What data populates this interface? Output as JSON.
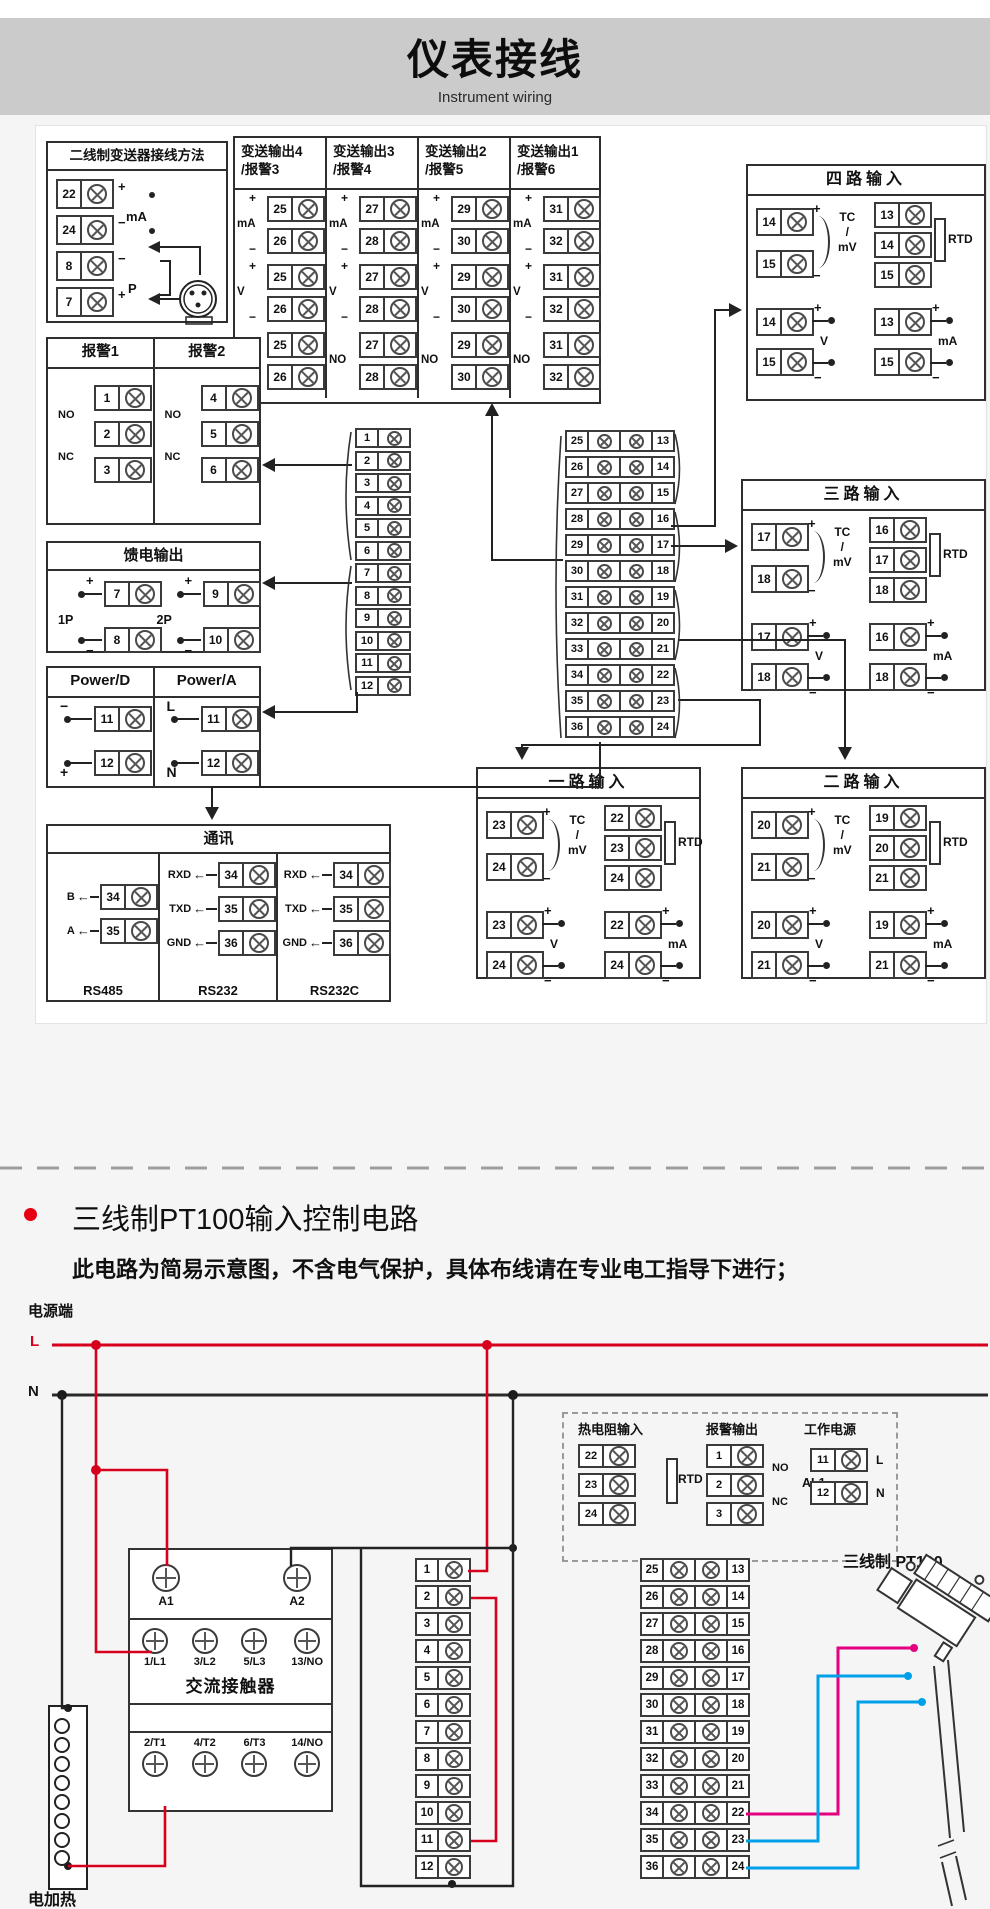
{
  "header": {
    "title": "仪表接线",
    "subtitle": "Instrument wiring"
  },
  "colors": {
    "accent_red": "#e60012",
    "wire_red": "#d6001c",
    "wire_magenta": "#e4007f",
    "wire_cyan": "#00a0e9",
    "wire_dark": "#222222",
    "header_band": "#cbcbcb"
  },
  "top": {
    "two_wire": {
      "title": "二线制变送器接线方法",
      "rows": [
        {
          "num": "22",
          "lab": "+"
        },
        {
          "num": "24",
          "lab": "−"
        },
        {
          "num": "8",
          "lab": "−"
        },
        {
          "num": "7",
          "lab": "+"
        }
      ],
      "ma": "mA",
      "p": "P"
    },
    "transmit": {
      "syms": {
        "plus": "+",
        "minus": "−",
        "ma": "mA",
        "v": "V",
        "no": "NO"
      },
      "cols": [
        {
          "t": "变送输出4",
          "s": "/报警3",
          "a": "25",
          "b": "26"
        },
        {
          "t": "变送输出3",
          "s": "/报警4",
          "a": "27",
          "b": "28"
        },
        {
          "t": "变送输出2",
          "s": "/报警5",
          "a": "29",
          "b": "30"
        },
        {
          "t": "变送输出1",
          "s": "/报警6",
          "a": "31",
          "b": "32"
        }
      ]
    },
    "inputs": [
      {
        "title": "四路输入",
        "tc1": "14",
        "tc2": "15",
        "r1": "13",
        "r2": "14",
        "r3": "15",
        "v1": "14",
        "v2": "15",
        "m1": "13",
        "m2": "15"
      },
      {
        "title": "三路输入",
        "tc1": "17",
        "tc2": "18",
        "r1": "16",
        "r2": "17",
        "r3": "18",
        "v1": "17",
        "v2": "18",
        "m1": "16",
        "m2": "18"
      },
      {
        "title": "一路输入",
        "tc1": "23",
        "tc2": "24",
        "r1": "22",
        "r2": "23",
        "r3": "24",
        "v1": "23",
        "v2": "24",
        "m1": "22",
        "m2": "24"
      },
      {
        "title": "二路输入",
        "tc1": "20",
        "tc2": "21",
        "r1": "19",
        "r2": "20",
        "r3": "21",
        "v1": "20",
        "v2": "21",
        "m1": "19",
        "m2": "21"
      }
    ],
    "input_labels": {
      "tc": "TC",
      "slash": "/",
      "mv": "mV",
      "rtd": "RTD",
      "v": "V",
      "ma": "mA",
      "plus": "+",
      "minus": "−"
    },
    "alarm": {
      "sections": [
        {
          "title": "报警1",
          "a": "1",
          "b": "2",
          "c": "3"
        },
        {
          "title": "报警2",
          "a": "4",
          "b": "5",
          "c": "6"
        }
      ],
      "no": "NO",
      "nc": "NC"
    },
    "feed": {
      "title": "馈电输出",
      "groups": [
        {
          "lab": "1P",
          "a": "7",
          "b": "8"
        },
        {
          "lab": "2P",
          "a": "9",
          "b": "10"
        }
      ]
    },
    "power": {
      "sections": [
        {
          "title": "Power/D",
          "l1": "−",
          "a": "11",
          "l2": "+",
          "b": "12"
        },
        {
          "title": "Power/A",
          "l1": "L",
          "a": "11",
          "l2": "N",
          "b": "12"
        }
      ]
    },
    "comm": {
      "title": "通讯",
      "arrow": "←",
      "sec1": {
        "cap": "RS485",
        "rows": [
          {
            "sig": "B",
            "t": "34"
          },
          {
            "sig": "A",
            "t": "35"
          }
        ]
      },
      "sec2": {
        "cap": "RS232",
        "rows": [
          {
            "sig": "RXD",
            "t": "34"
          },
          {
            "sig": "TXD",
            "t": "35"
          },
          {
            "sig": "GND",
            "t": "36"
          }
        ]
      },
      "sec3": {
        "cap": "RS232C",
        "rows": [
          {
            "sig": "RXD",
            "t": "34"
          },
          {
            "sig": "TXD",
            "t": "35"
          },
          {
            "sig": "GND",
            "t": "36"
          }
        ]
      }
    },
    "strip_a": [
      "1",
      "2",
      "3",
      "4",
      "5",
      "6",
      "7",
      "8",
      "9",
      "10",
      "11",
      "12"
    ],
    "strip_b": [
      {
        "l": "25",
        "r": "13"
      },
      {
        "l": "26",
        "r": "14"
      },
      {
        "l": "27",
        "r": "15"
      },
      {
        "l": "28",
        "r": "16"
      },
      {
        "l": "29",
        "r": "17"
      },
      {
        "l": "30",
        "r": "18"
      },
      {
        "l": "31",
        "r": "19"
      },
      {
        "l": "32",
        "r": "20"
      },
      {
        "l": "33",
        "r": "21"
      },
      {
        "l": "34",
        "r": "22"
      },
      {
        "l": "35",
        "r": "23"
      },
      {
        "l": "36",
        "r": "24"
      }
    ]
  },
  "notes": [
    "注1：接线图中在同一组端子标有不同功能的,只能选择其中一种功能。",
    "如RS485和RS232在同一组接线端子上，只能选择一种。",
    "注2：不同外形尺寸仪表，接线图不尽相同，请以实物为准。"
  ],
  "pt100": {
    "heading": "三线制PT100输入控制电路",
    "sub": "此电路为简易示意图，不含电气保护，具体布线请在专业电工指导下进行；",
    "power_label": "电源端",
    "l": "L",
    "n": "N",
    "dashed": {
      "rtd": {
        "title": "热电阻输入",
        "rows": [
          "22",
          "23",
          "24"
        ],
        "lab": "RTD"
      },
      "alarm": {
        "title": "报警输出",
        "rows": [
          "1",
          "2",
          "3"
        ],
        "no": "NO",
        "nc": "NC",
        "al1": "AL1"
      },
      "work": {
        "title": "工作电源",
        "rows": [
          {
            "t": "11",
            "lab": "L"
          },
          {
            "t": "12",
            "lab": "N"
          }
        ]
      }
    },
    "contactor": {
      "coils": [
        {
          "lab": "A1"
        },
        {
          "lab": "A2"
        }
      ],
      "top": [
        {
          "lab": "1/L1"
        },
        {
          "lab": "3/L2"
        },
        {
          "lab": "5/L3"
        },
        {
          "lab": "13/NO"
        }
      ],
      "name": "交流接触器",
      "bottom": [
        {
          "lab": "2/T1"
        },
        {
          "lab": "4/T2"
        },
        {
          "lab": "6/T3"
        },
        {
          "lab": "14/NO"
        }
      ]
    },
    "heater": "电加热",
    "sensor": "三线制 PT100",
    "wire_labels": [
      "A",
      "B",
      "B"
    ],
    "strip_a": [
      "1",
      "2",
      "3",
      "4",
      "5",
      "6",
      "7",
      "8",
      "9",
      "10",
      "11",
      "12"
    ],
    "strip_b": [
      {
        "l": "25",
        "r": "13"
      },
      {
        "l": "26",
        "r": "14"
      },
      {
        "l": "27",
        "r": "15"
      },
      {
        "l": "28",
        "r": "16"
      },
      {
        "l": "29",
        "r": "17"
      },
      {
        "l": "30",
        "r": "18"
      },
      {
        "l": "31",
        "r": "19"
      },
      {
        "l": "32",
        "r": "20"
      },
      {
        "l": "33",
        "r": "21"
      },
      {
        "l": "34",
        "r": "22"
      },
      {
        "l": "35",
        "r": "23"
      },
      {
        "l": "36",
        "r": "24"
      }
    ]
  }
}
